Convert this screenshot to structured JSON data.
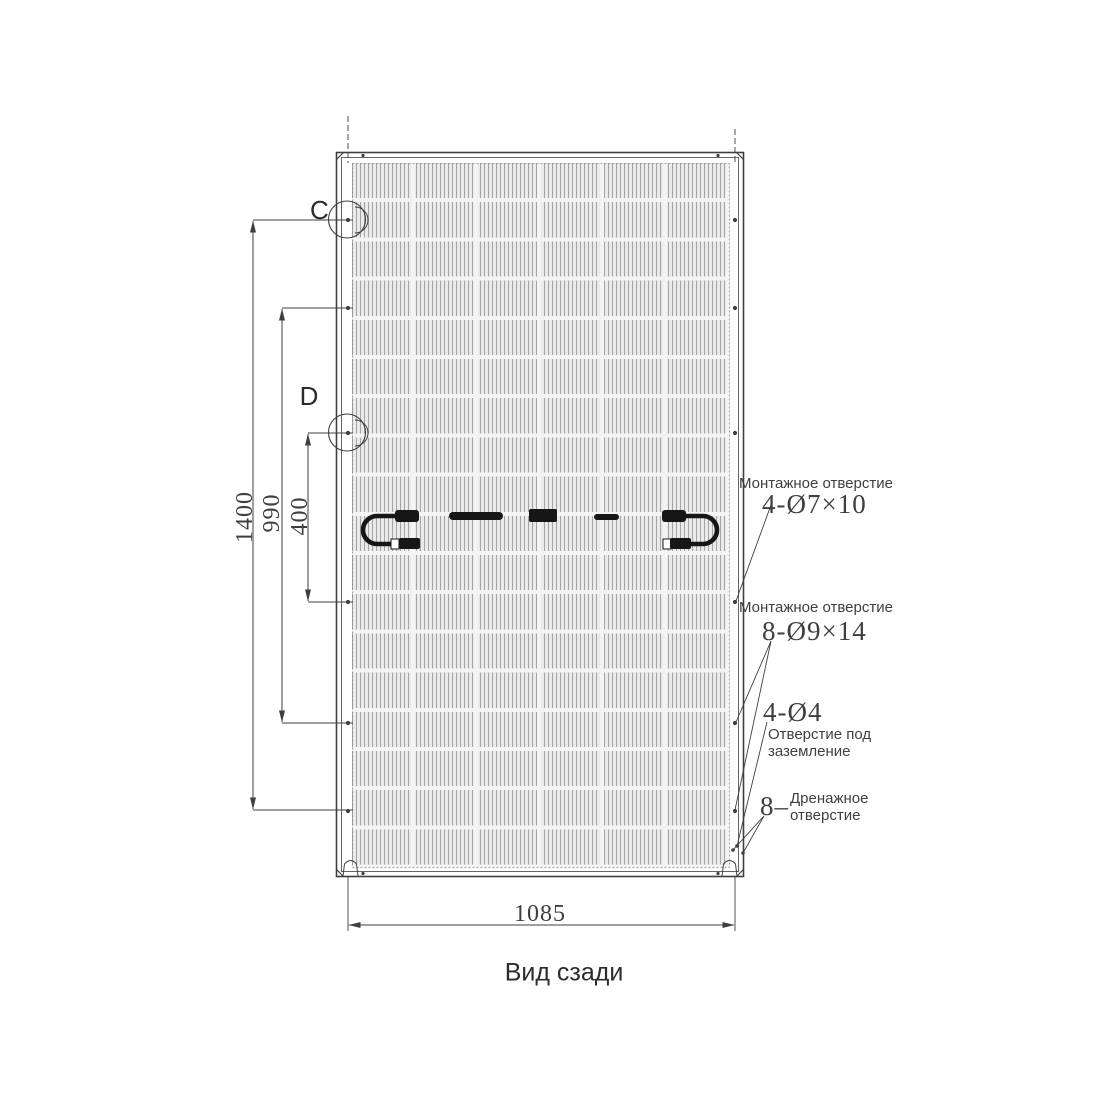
{
  "colors": {
    "ink": "#3f3f3f",
    "ink_strong": "#2b2b2b",
    "black": "#161616",
    "cell_bg": "#eaeaea",
    "cell_stripe": "#a4a4a4",
    "cell_gap": "#f4f4f4"
  },
  "caption": "Вид сзади",
  "detail_labels": {
    "c": "C",
    "d": "D"
  },
  "dimensions": {
    "overall_height": "1400",
    "mounting_span_outer": "990",
    "mounting_span_inner": "400",
    "overall_width": "1085"
  },
  "callouts": {
    "mounting_hole_top": {
      "label": "Монтажное отверстие",
      "spec": "4-Ø7×10"
    },
    "mounting_hole_mid": {
      "label": "Монтажное отверстие",
      "spec": "8-Ø9×14"
    },
    "grounding": {
      "spec": "4-Ø4",
      "label": "Отверстие под\nзаземление"
    },
    "drainage": {
      "spec": "8–",
      "label": "Дренажное\nотверстие"
    }
  }
}
